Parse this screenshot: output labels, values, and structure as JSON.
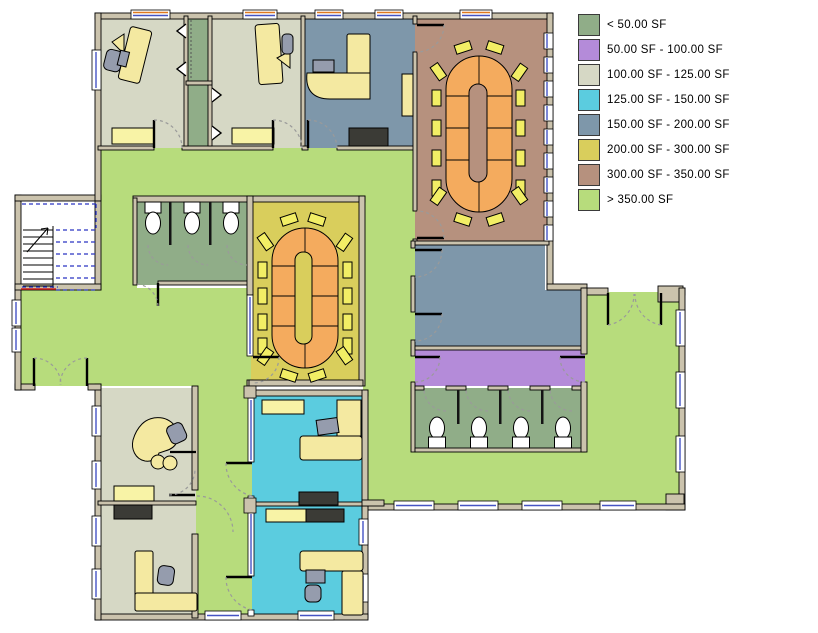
{
  "legend": {
    "items": [
      {
        "label": "< 50.00 SF",
        "color": "#90ad88"
      },
      {
        "label": "50.00 SF - 100.00 SF",
        "color": "#b48bd9"
      },
      {
        "label": "100.00 SF - 125.00 SF",
        "color": "#d6d8c5"
      },
      {
        "label": "125.00 SF - 150.00 SF",
        "color": "#5bccdf"
      },
      {
        "label": "150.00 SF - 200.00 SF",
        "color": "#7e97aa"
      },
      {
        "label": "200.00 SF - 300.00 SF",
        "color": "#d9ce5c"
      },
      {
        "label": "300.00 SF - 350.00 SF",
        "color": "#b6917e"
      },
      {
        "label": "> 350.00 SF",
        "color": "#b7dc7c"
      }
    ]
  },
  "rooms": [
    {
      "id": "office-northwest-1",
      "range": "100.00 SF - 125.00 SF"
    },
    {
      "id": "storage-closet",
      "range": "< 50.00 SF"
    },
    {
      "id": "office-northwest-2",
      "range": "100.00 SF - 125.00 SF"
    },
    {
      "id": "office-north",
      "range": "150.00 SF - 200.00 SF"
    },
    {
      "id": "conference-room-north",
      "range": "300.00 SF - 350.00 SF"
    },
    {
      "id": "restroom-west",
      "range": "< 50.00 SF"
    },
    {
      "id": "conference-room-center",
      "range": "200.00 SF - 300.00 SF"
    },
    {
      "id": "meeting-room-east",
      "range": "150.00 SF - 200.00 SF"
    },
    {
      "id": "vestibule-east",
      "range": "50.00 SF - 100.00 SF"
    },
    {
      "id": "restroom-south",
      "range": "< 50.00 SF"
    },
    {
      "id": "office-southwest-1",
      "range": "100.00 SF - 125.00 SF"
    },
    {
      "id": "office-southwest-2",
      "range": "100.00 SF - 125.00 SF"
    },
    {
      "id": "office-south-1",
      "range": "125.00 SF - 150.00 SF"
    },
    {
      "id": "office-south-2",
      "range": "125.00 SF - 150.00 SF"
    },
    {
      "id": "corridor-open-area",
      "range": "> 350.00 SF"
    }
  ],
  "palette": {
    "wall": "#cbc3ad",
    "stair_fill": "#ffffff",
    "window_fill": "#ffffff",
    "desk": "#f4e9a1",
    "shelf": "#f8f3a6",
    "dark_furniture": "#3b3b36",
    "chair_gray": "#959cad",
    "chair_yellow": "#f2ee65",
    "table_orange": "#f4ab5e",
    "equipment_gray": "#7e8490",
    "toilet": "#ffffff",
    "glazing_blue": "#4553c4",
    "accent_orange": "#e0791e",
    "partition_dark": "#141414",
    "door_arc": "#9a9a9a",
    "door_leaf": "#000000",
    "stair_rail_blue": "#2a35c2",
    "exit_red": "#cf1f1f"
  }
}
